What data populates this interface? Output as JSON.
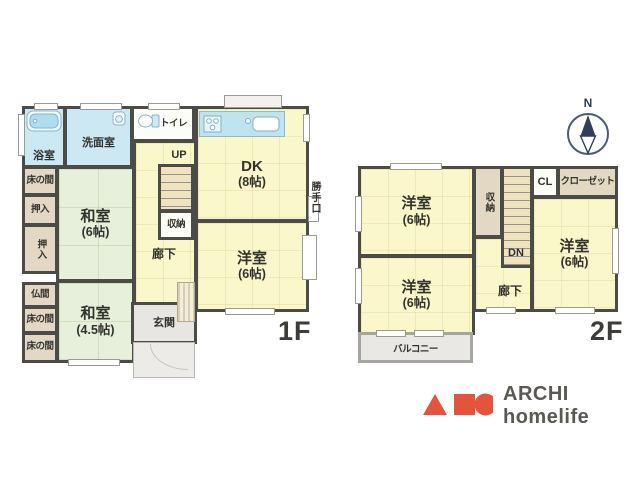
{
  "f1": {
    "floor_label": "1F",
    "bath": {
      "name": "浴室"
    },
    "washroom": {
      "name": "洗面室"
    },
    "toilet": {
      "name": "トイレ"
    },
    "tokonoma_a": {
      "name": "床の間"
    },
    "oshiire_a": {
      "name": "押入"
    },
    "oshiire_b": {
      "name": "押入"
    },
    "butsuma": {
      "name": "仏間"
    },
    "tokonoma_b": {
      "name": "床の間"
    },
    "tokonoma_c": {
      "name": "床の間"
    },
    "washitsu6": {
      "name": "和室",
      "size": "(6帖)"
    },
    "washitsu45": {
      "name": "和室",
      "size": "(4.5帖)"
    },
    "dk": {
      "name": "DK",
      "size": "(8帖)"
    },
    "yoshitsu": {
      "name": "洋室",
      "size": "(6帖)"
    },
    "up_label": "UP",
    "shuno": {
      "name": "収納"
    },
    "rouka": {
      "name": "廊下"
    },
    "genkan": {
      "name": "玄関"
    },
    "katteguchi_label": "勝手口"
  },
  "f2": {
    "floor_label": "2F",
    "yoshitsu_nw": {
      "name": "洋室",
      "size": "(6帖)"
    },
    "yoshitsu_sw": {
      "name": "洋室",
      "size": "(6帖)"
    },
    "yoshitsu_e": {
      "name": "洋室",
      "size": "(6帖)"
    },
    "shuno": {
      "name": "収納"
    },
    "cl": {
      "name": "CL"
    },
    "closet": {
      "name": "クローゼット"
    },
    "dn_label": "DN",
    "rouka": {
      "name": "廊下"
    },
    "balcony": {
      "name": "バルコニー"
    }
  },
  "compass": {
    "north_label": "N"
  },
  "logo": {
    "brand_text": "ARCHI homelife"
  },
  "colors": {
    "room_yellow": "#faf7cb",
    "tatami_green": "#e6f0da",
    "wet_blue": "#cbe8f3",
    "closet_tan": "#e2d8c3",
    "stairs_beige": "#efe3bf",
    "wall_dark": "#4b4b47",
    "entry_gray": "#e7e6e2",
    "logo_orange": "#e4543c",
    "compass_navy": "#2e3f5c"
  }
}
